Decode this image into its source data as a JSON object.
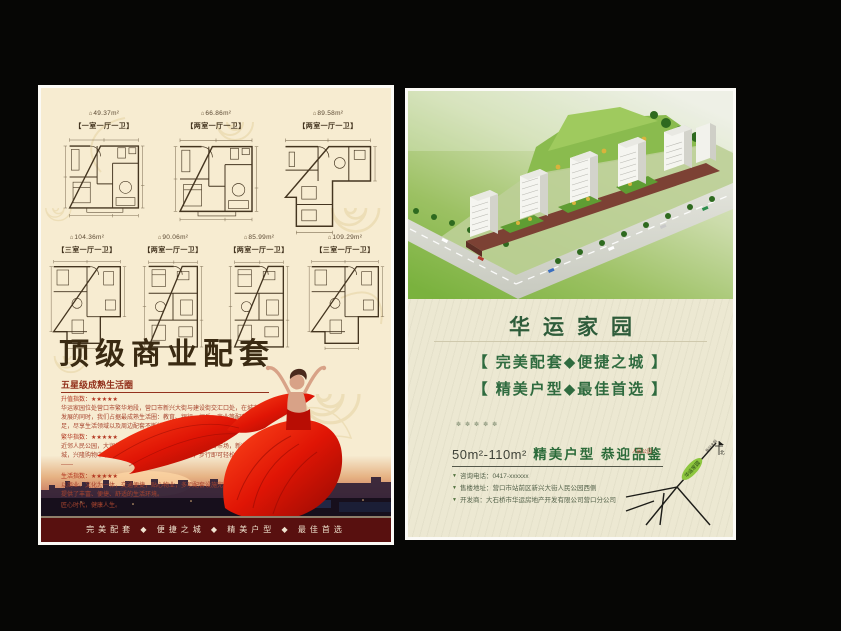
{
  "icons": {
    "plan_marker": "⌂",
    "bullet_down": "▼"
  },
  "page_left": {
    "floor_plans_row1": [
      {
        "area": "49.37m²",
        "type": "【一室一厅一卫】"
      },
      {
        "area": "66.86m²",
        "type": "【两室一厅一卫】"
      },
      {
        "area": "89.58m²",
        "type": "【两室一厅一卫】"
      }
    ],
    "floor_plans_row2": [
      {
        "area": "104.36m²",
        "type": "【三室一厅一卫】"
      },
      {
        "area": "90.06m²",
        "type": "【两室一厅一卫】"
      },
      {
        "area": "85.99m²",
        "type": "【两室一厅一卫】"
      },
      {
        "area": "109.29m²",
        "type": "【三室一厅一卫】"
      }
    ],
    "title": "顶级商业配套",
    "subtitle": "五星级成熟生活圈",
    "body": [
      {
        "label": "升值指数：★★★★★",
        "text": "华运家园位处营口市繁华地段，营口市新兴大街与建设街交汇口处，在城市不断发展的同时，我们占据最成熟生活圈：教育、银行、娱乐、商业等配套资源充足，尽享生活领域以及周边配套不断壮大。"
      },
      {
        "label": "繁华指数：★★★★★",
        "text": "近邻人民公园，大润发超市，万家隆超市，东升市场，百合市场，新兴地下商城，兴隆购物中心，中国银行，北辰步行商业街等，步行即可轻松享受生活乐趣——"
      },
      {
        "label": "生活指数：★★★★★",
        "text": "以商业、文化为一体，交通便捷，贴心物业，多项配套设施完善，为本小区业主提供了丰富、便捷、舒适的生活环境。"
      }
    ],
    "closing": "匠心时代，健康人生。",
    "footer": "完美配套 ◆ 便捷之城 ◆ 精美户型 ◆ 最佳首选"
  },
  "page_right": {
    "title": "华运家园",
    "slogan1": "【 完美配套◆便捷之城 】",
    "slogan2": "【 精美户型◆最佳首选 】",
    "decor": "✽✽✽✽✽",
    "offer_range": "50m²-110m²",
    "offer_text": "精美户型 恭迎品鉴",
    "contacts": [
      "咨询电话：0417-xxxxxx",
      "售楼地址：营口市站前区新兴大街人民公园西侧",
      "开发商：大石桥市华运房地产开发有限公司营口分公司"
    ],
    "map": {
      "park": "人民公园",
      "project": "华运家园",
      "road": "新兴大街",
      "north": "北"
    }
  },
  "colors": {
    "accent_red": "#e01505",
    "maroon": "#5a1013",
    "green_title": "#2e5c3a",
    "leaf_green": "#8dc63e",
    "cream": "#f7ecd1"
  }
}
